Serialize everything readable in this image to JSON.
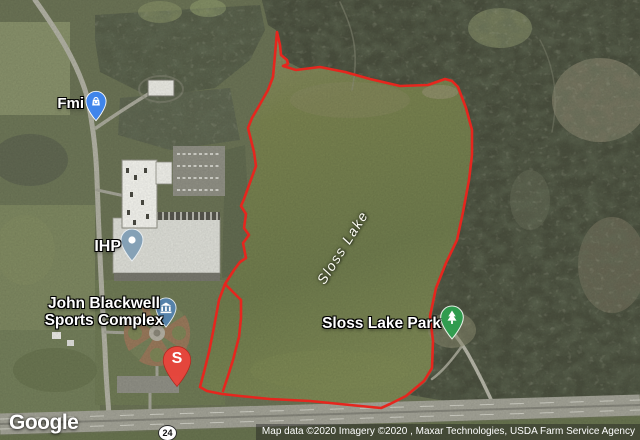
{
  "map": {
    "water_label": "Sloss Lake",
    "route_shield": "24",
    "pois": {
      "fmi": {
        "label": "Fmi",
        "icon": "shopping-bag-pin",
        "pin_color": "#3f86f0"
      },
      "ihp": {
        "label": "IHP",
        "icon": "generic-poi-pin",
        "pin_color": "#83a0b6"
      },
      "sports_complex": {
        "label_line1": "John Blackwell",
        "label_line2": "Sports Complex",
        "icon": "civic-building-pin",
        "pin_color": "#5583ad"
      },
      "park": {
        "label": "Sloss Lake Park",
        "icon": "tree-pin",
        "pin_color": "#2f9e4f"
      },
      "marker_s": {
        "letter": "S",
        "icon": "red-letter-pin",
        "pin_color": "#e8453c"
      }
    },
    "boundary_color": "#e5261e"
  },
  "footer": {
    "logo": "Google",
    "attribution": "Map data ©2020  Imagery ©2020 , Maxar Technologies, USDA Farm Service Agency"
  }
}
